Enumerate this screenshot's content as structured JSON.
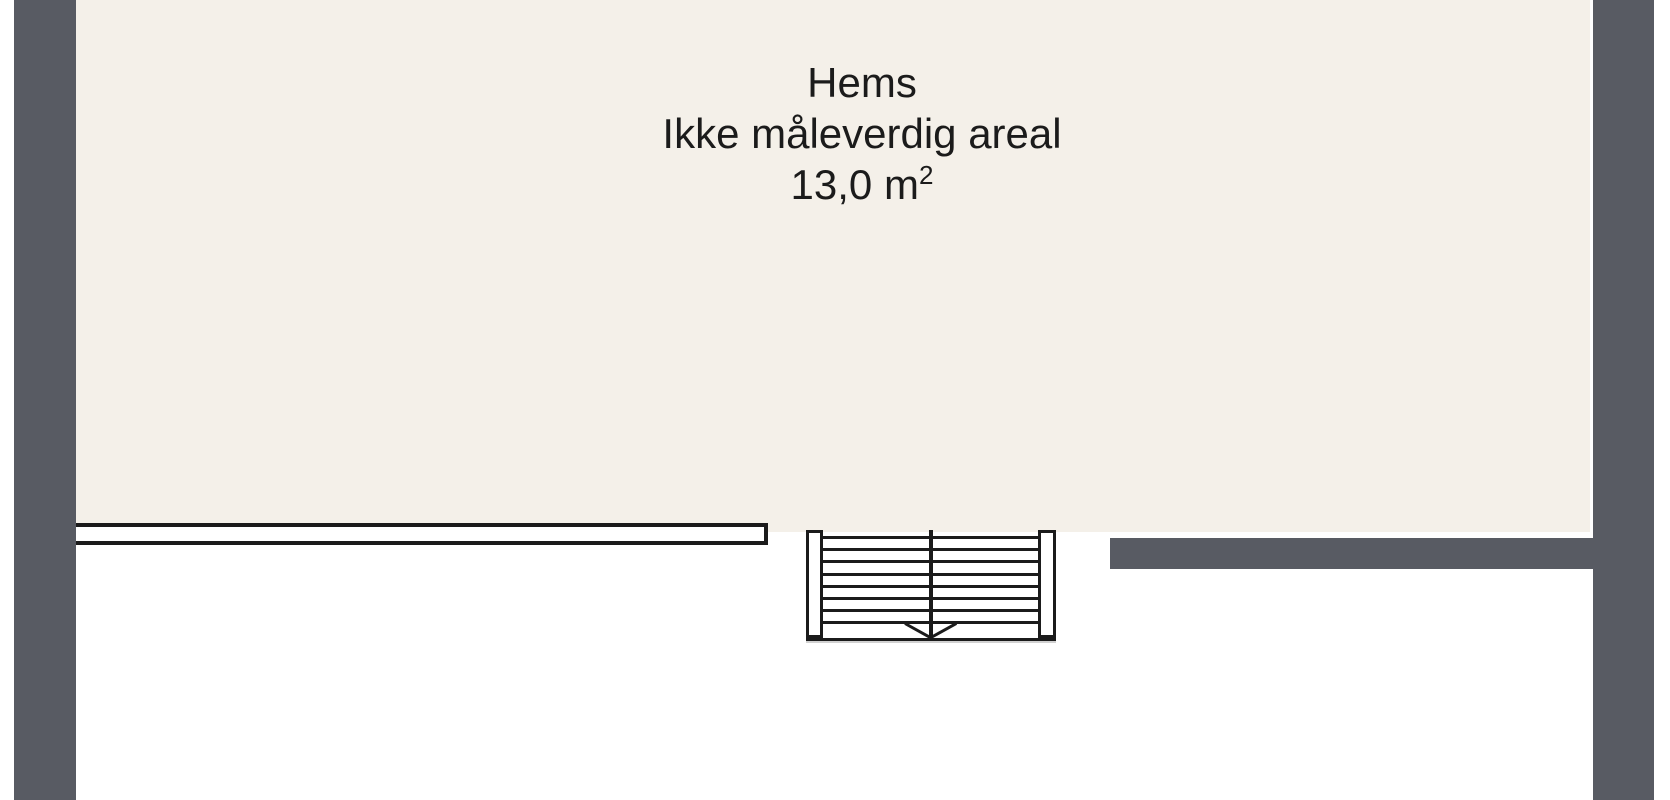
{
  "floorplan": {
    "room": {
      "name": "Hems",
      "note": "Ikke måleverdig areal",
      "area_value": "13,0 m",
      "area_superscript": "2"
    },
    "stair": {
      "tread_lines": 8,
      "direction_icon": "arrow-down"
    },
    "colors": {
      "wall": "#585b63",
      "room_fill": "#f4f0e9",
      "line": "#1b1b1b",
      "background": "#ffffff"
    }
  }
}
